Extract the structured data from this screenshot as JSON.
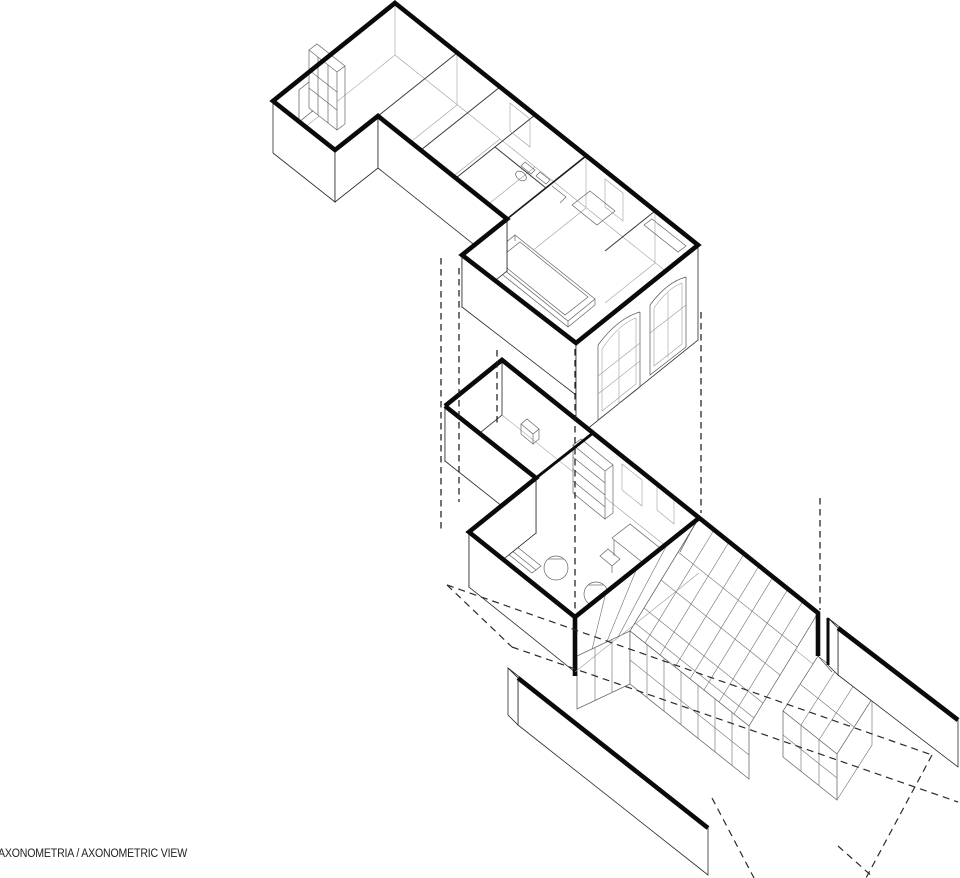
{
  "caption": {
    "text": "AXONOMETRIA / AXONOMETRIC VIEW"
  },
  "colors": {
    "background": "#ffffff",
    "ink": "#0a0a0a",
    "line_medium": "#444444",
    "line_thin": "#777777",
    "line_faint": "#aaaaaa"
  }
}
